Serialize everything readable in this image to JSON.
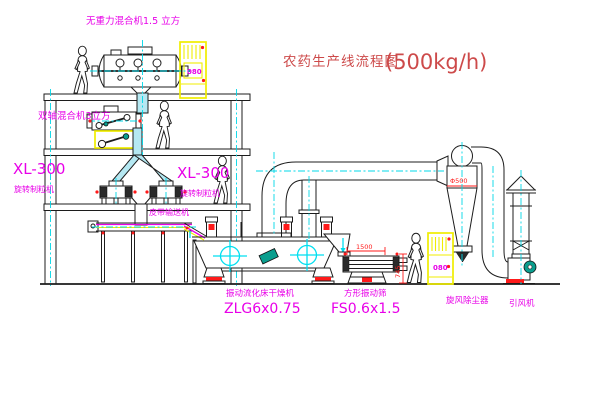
{
  "title": {
    "text": "农药生产线流程图",
    "capacity": "(500kg/h)"
  },
  "labels": {
    "top_mixer": "无重力混合机1.5 立方",
    "second_mixer": "双轴混合机3立方",
    "granulator_left": {
      "model": "XL-300",
      "name": "旋转制粒机"
    },
    "granulator_right": {
      "model": "XL-300",
      "name": "旋转制粒机"
    },
    "belt_conveyor": "皮带输送机",
    "dryer": {
      "name": "振动流化床干燥机",
      "model": "ZLG6x0.75"
    },
    "sieve": {
      "name": "方形振动筛",
      "model": "FS0.6x1.5"
    },
    "cyclone": "旋风除尘器",
    "fan": "引风机"
  },
  "dimensions": {
    "sieve_length": "1500",
    "sieve_height": "745",
    "cyclone_diameter": "Φ500"
  },
  "control_cabinets": {
    "top_panel_text": "080",
    "ground_panel_text": "080"
  },
  "colors": {
    "line_black": "#1c1c1c",
    "centerline_cyan": "#00d8e8",
    "pipe_fill_cyan": "#b5e8f2",
    "label_magenta": "#e800e8",
    "title_red": "#cd4a4a",
    "dimension_red": "#ff1a1a",
    "cabinet_yellow": "#f0ed00",
    "motor_teal": "#0a9e8e"
  }
}
